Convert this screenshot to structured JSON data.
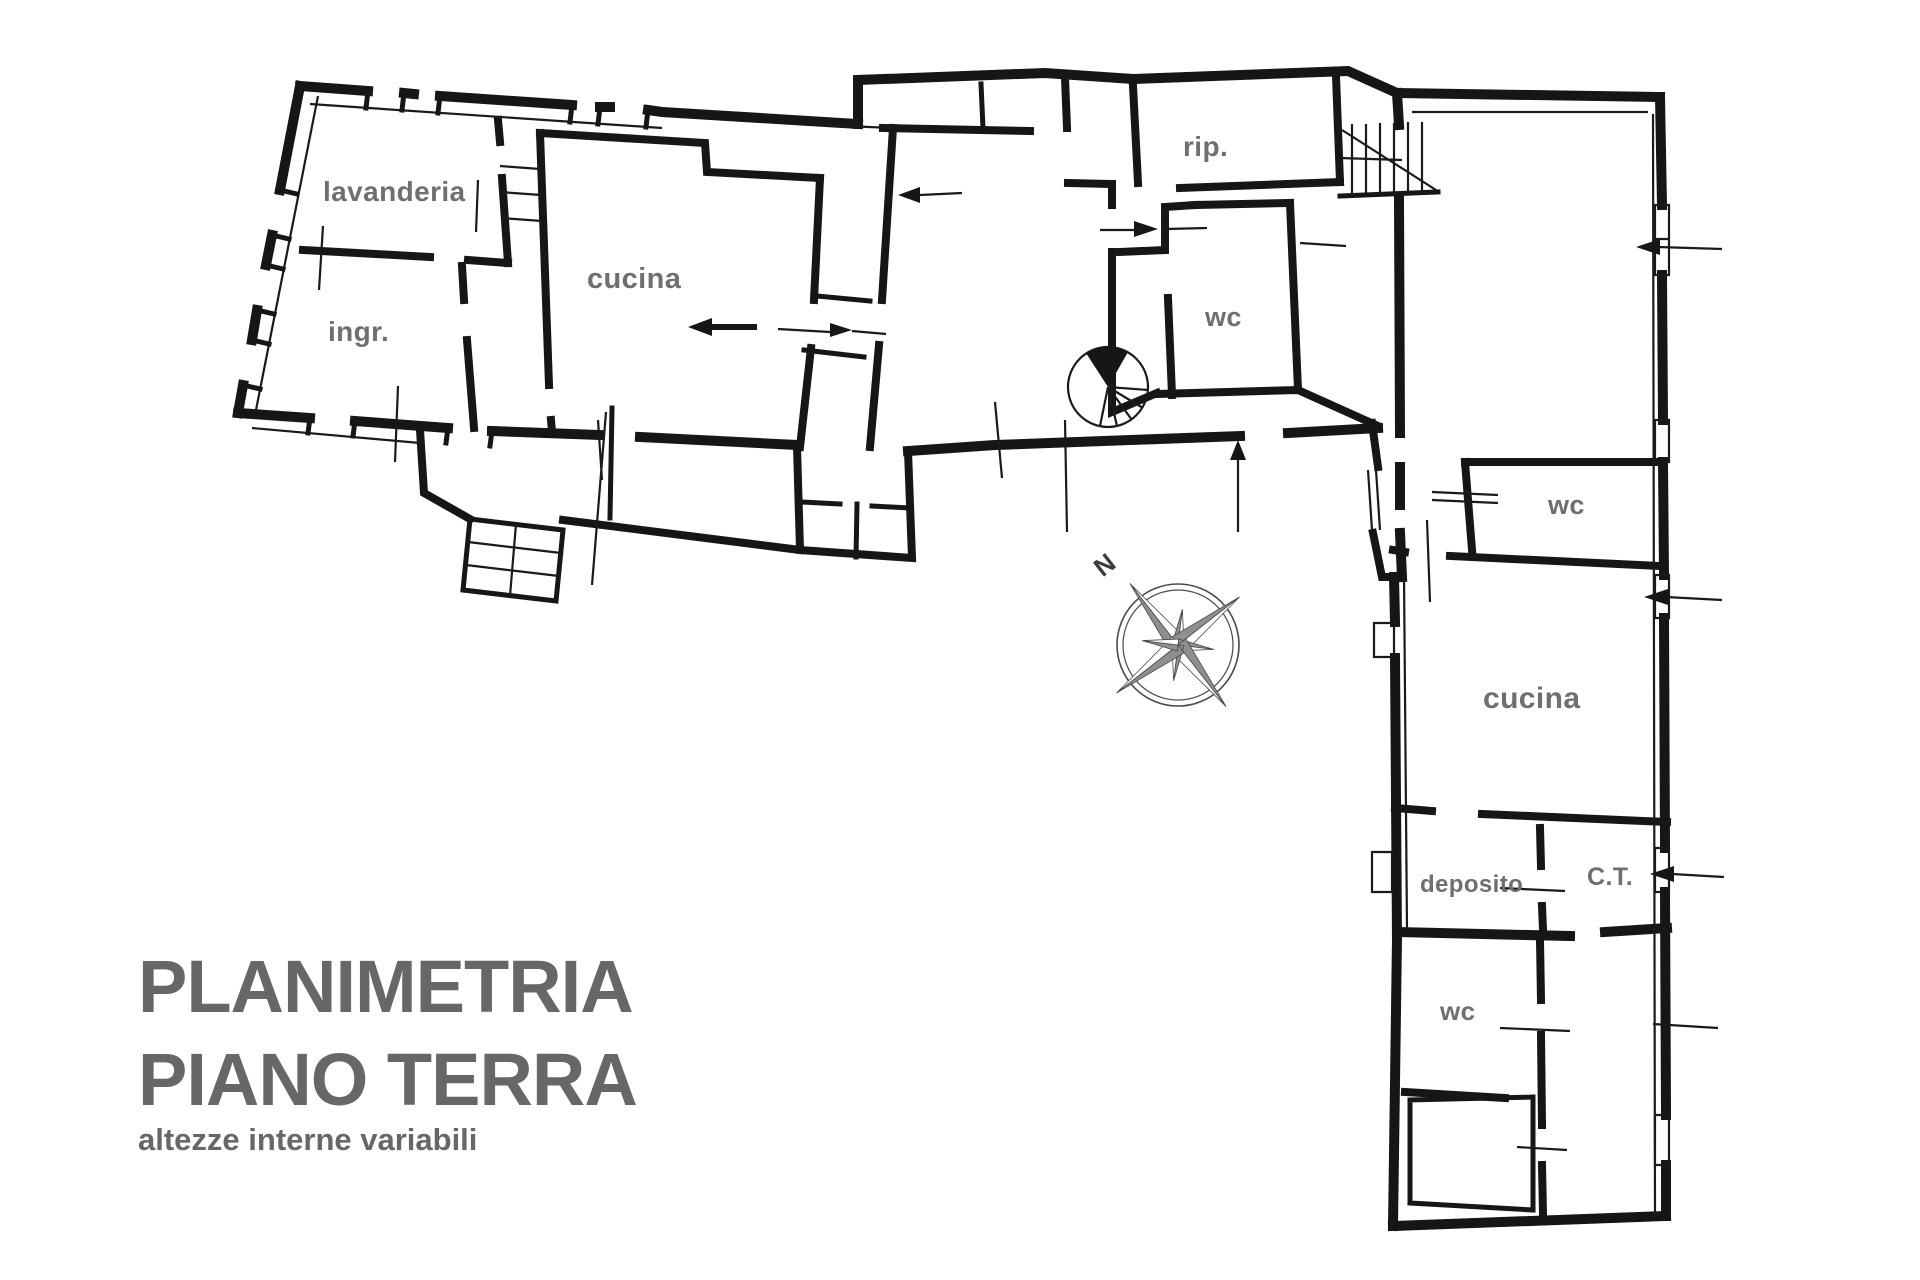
{
  "title": {
    "line1": "PLANIMETRIA",
    "line2": "PIANO TERRA",
    "subtitle": "altezze interne variabili"
  },
  "compass": {
    "north_label": "N"
  },
  "rooms": [
    {
      "id": "lavanderia",
      "label": "lavanderia",
      "x": 323,
      "y": 176,
      "size": 28
    },
    {
      "id": "ingr",
      "label": "ingr.",
      "x": 328,
      "y": 316,
      "size": 28
    },
    {
      "id": "cucina-left",
      "label": "cucina",
      "x": 587,
      "y": 263,
      "size": 29
    },
    {
      "id": "rip",
      "label": "rip.",
      "x": 1183,
      "y": 131,
      "size": 28
    },
    {
      "id": "wc-center",
      "label": "wc",
      "x": 1205,
      "y": 302,
      "size": 27
    },
    {
      "id": "wc-wing",
      "label": "wc",
      "x": 1548,
      "y": 490,
      "size": 27
    },
    {
      "id": "cucina-wing",
      "label": "cucina",
      "x": 1483,
      "y": 682,
      "size": 30
    },
    {
      "id": "deposito",
      "label": "deposito",
      "x": 1420,
      "y": 871,
      "size": 24
    },
    {
      "id": "ct",
      "label": "C.T.",
      "x": 1587,
      "y": 863,
      "size": 25
    },
    {
      "id": "wc-bottom",
      "label": "wc",
      "x": 1440,
      "y": 996,
      "size": 26
    }
  ],
  "colors": {
    "walls": "#161616",
    "label_gray": "#6f6f6f",
    "title_gray": "#676767",
    "compass_fill": "#8f8f8f"
  }
}
